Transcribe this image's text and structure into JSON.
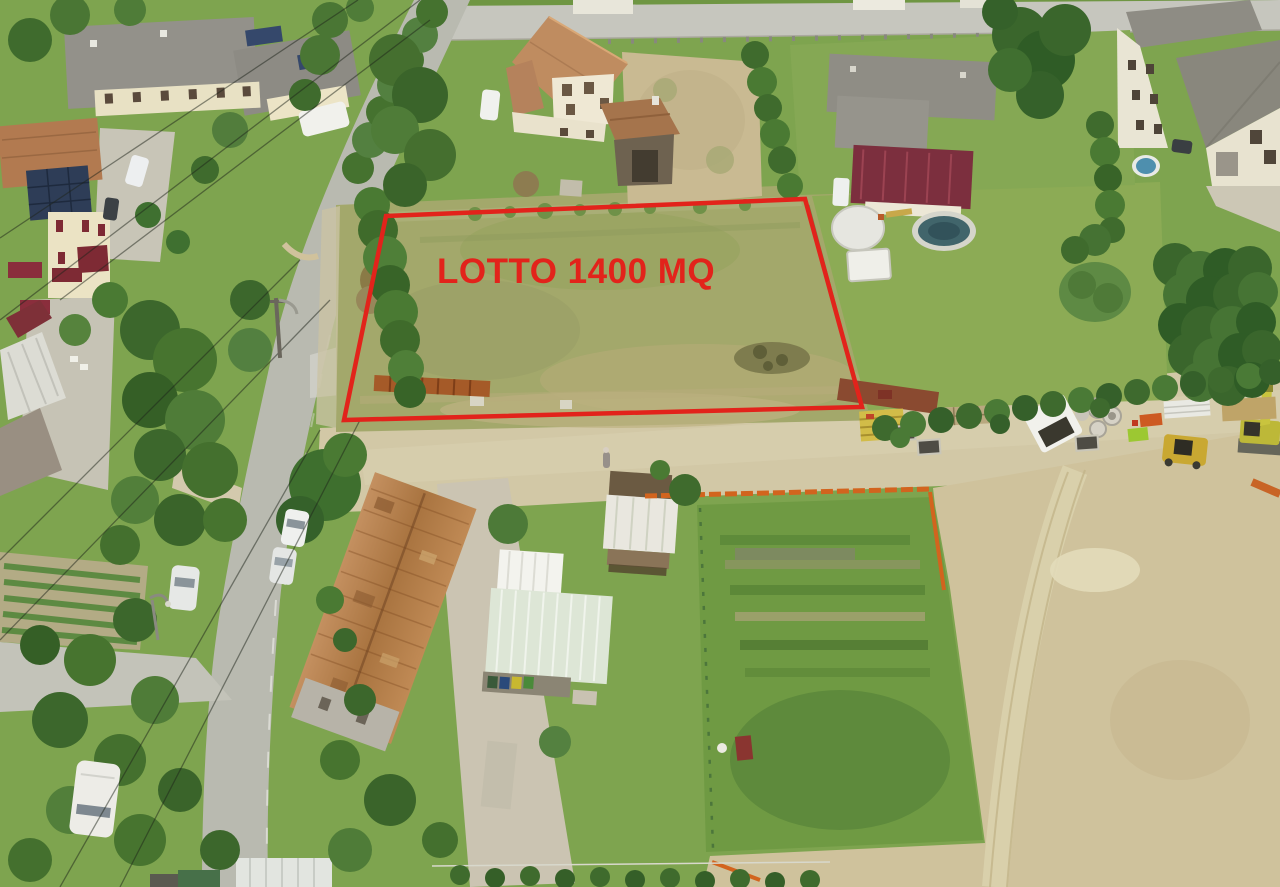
{
  "annotation": {
    "label": "LOTTO 1400 MQ",
    "color": "#e2231b",
    "shape": "quadrilateral-lot-outline"
  },
  "scene": {
    "type": "aerial-drone-photograph",
    "description": "Aerial photo of a suburban Italian neighborhood: a vacant grass building lot outlined in red between houses, a gravel road with construction equipment, farm buildings, sheds, gardens and a dirt construction area."
  }
}
